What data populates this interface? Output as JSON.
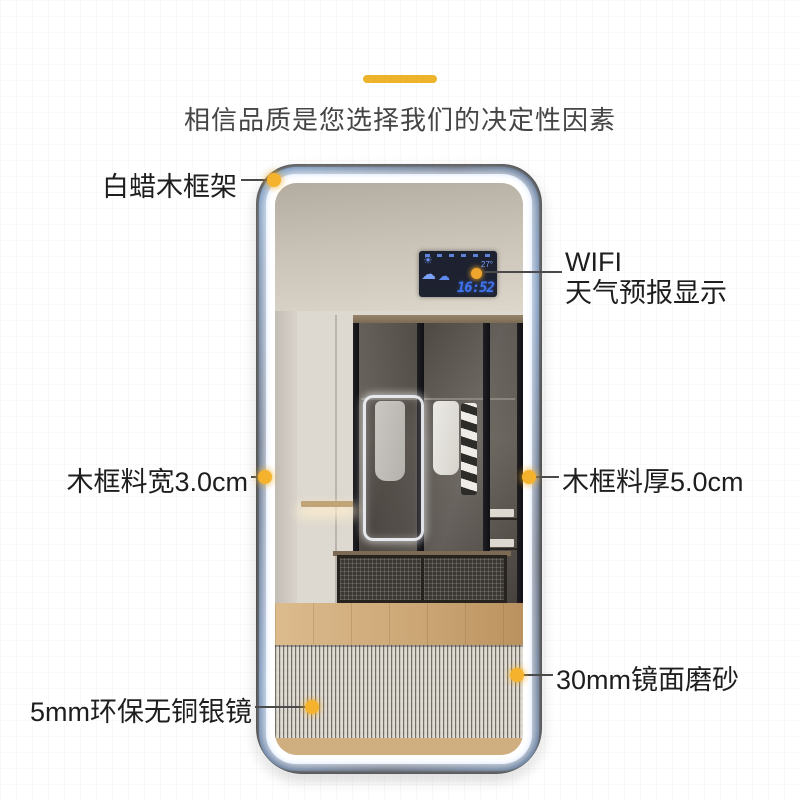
{
  "header": {
    "title": "相信品质是您选择我们的决定性因素"
  },
  "annotations": {
    "frame_material": "白蜡木框架",
    "wifi_line1": "WIFI",
    "wifi_line2": "天气预报显示",
    "frame_width": "木框料宽3.0cm",
    "frame_thickness": "木框料厚5.0cm",
    "mirror_frosted": "30mm镜面磨砂",
    "silver_mirror": "5mm环保无铜银镜"
  },
  "weather_display": {
    "temperature": "27°",
    "time": "16:52",
    "icons": {
      "sun_cloud": "☀",
      "cloud_large": "☁",
      "cloud_small": "☁"
    }
  },
  "colors": {
    "accent_yellow": "#edb32b",
    "callout_dot": "#f5b22c",
    "led_band_blue": "#2e5a94",
    "display_blue": "#3f74ee",
    "sun_yellow": "#f0a62e"
  }
}
